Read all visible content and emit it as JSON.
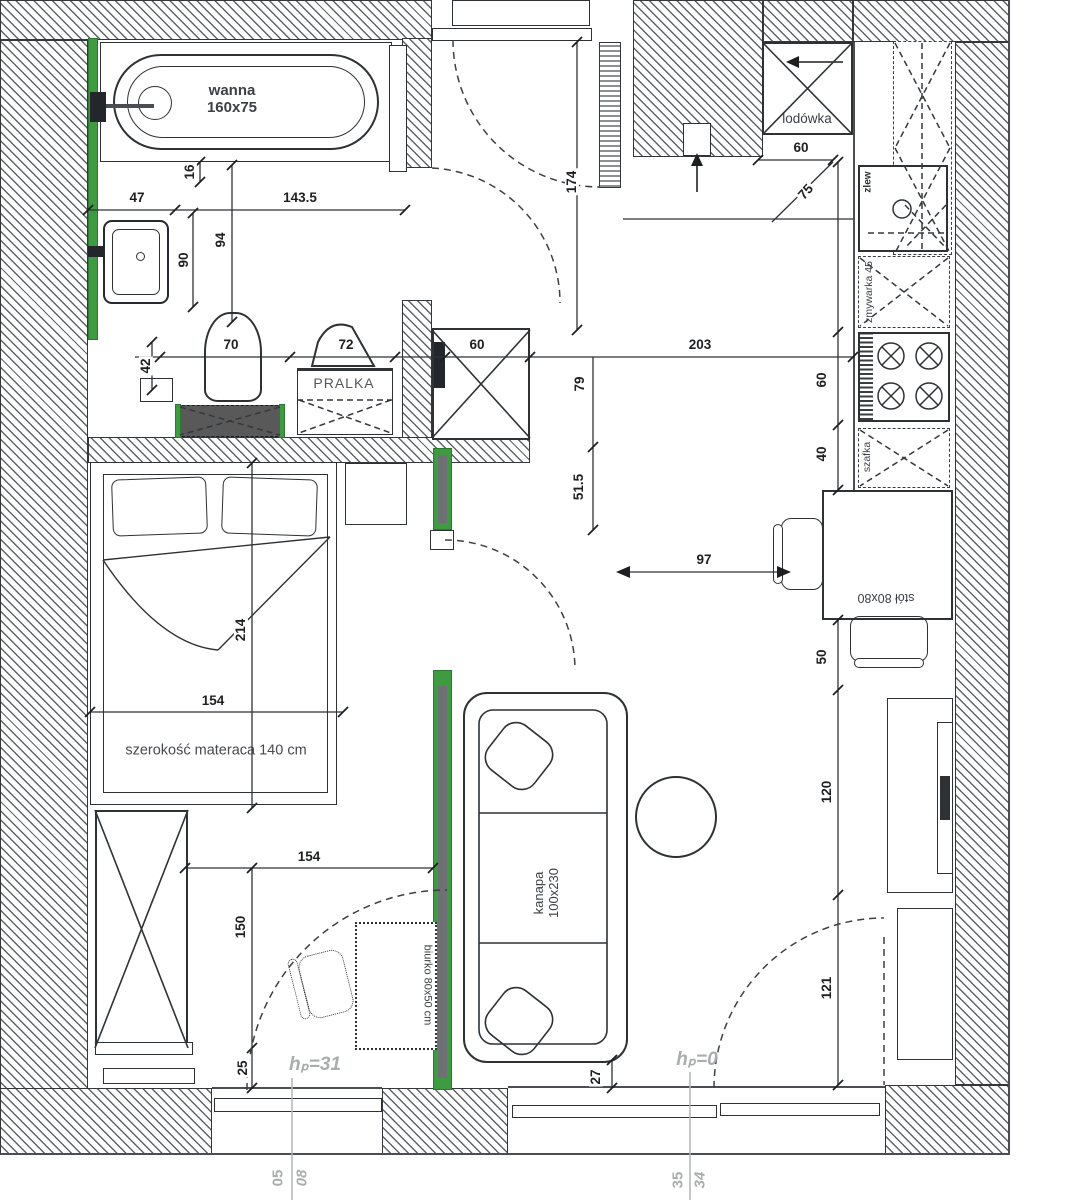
{
  "labels": {
    "bathtub": "wanna",
    "bathtub_size": "160x75",
    "washer": "PRALKA",
    "fridge": "lodówka",
    "kitchen_sink": "zlew",
    "dishwasher": "zmywarka 45",
    "cabinet": "szafka",
    "table": "stół 80x80",
    "sofa": "kanapa",
    "sofa_size": "100x230",
    "desk": "biurko 80x50 cm",
    "mattress_note": "szerokość materaca 140 cm",
    "level_left": "hₚ=31",
    "level_right": "hₚ=0",
    "num_05": "05",
    "num_08": "08",
    "num_35": "35",
    "num_34": "34"
  },
  "dims": {
    "sink_47": "47",
    "tub_16": "16",
    "bath_143_5": "143.5",
    "bath_94": "94",
    "bath_90": "90",
    "toilet_42": "42",
    "toilet_70": "70",
    "washer_72": "72",
    "shower_60": "60",
    "entry_174": "174",
    "hall_203": "203",
    "hall_79": "79",
    "hall_51_5": "51.5",
    "fridge_60": "60",
    "fridge_75": "75",
    "counter_60": "60",
    "counter_40": "40",
    "table_50": "50",
    "tv_120": "120",
    "balcony_121": "121",
    "bed_154": "154",
    "bed_214": "214",
    "room_154": "154",
    "wardrobe_150": "150",
    "gap_25": "25",
    "sofa_27": "27",
    "chair_97": "97"
  },
  "colors": {
    "accent_green": "#3f9b42",
    "wall_line": "#33373b",
    "dark_fill": "#595959",
    "note_gray": "#a9adad"
  }
}
